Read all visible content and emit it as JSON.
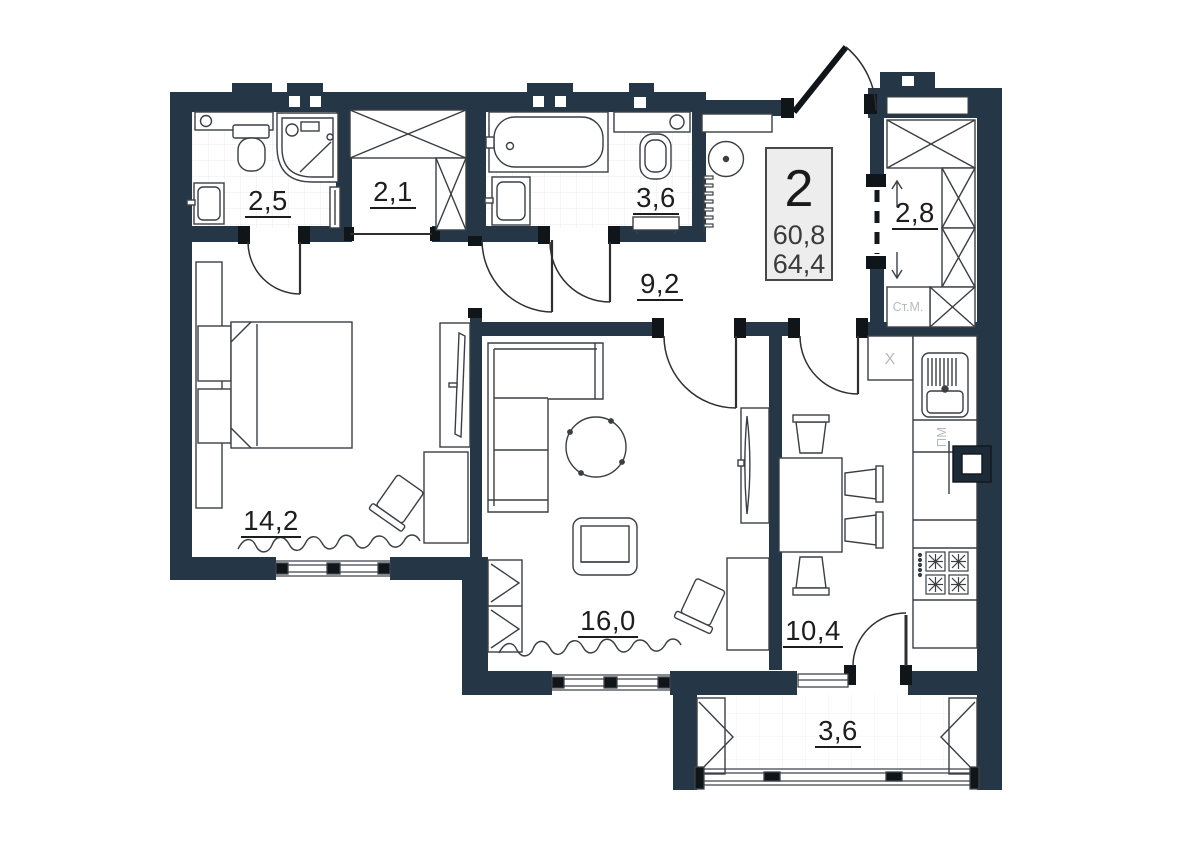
{
  "plan": {
    "info_box": {
      "rooms_count": "2",
      "area_main": "60,8",
      "area_total": "64,4"
    },
    "rooms": {
      "ensuite_bathroom": {
        "area": "2,5"
      },
      "wardrobe": {
        "area": "2,1"
      },
      "bathroom": {
        "area": "3,6"
      },
      "hallway": {
        "area": "9,2"
      },
      "laundry": {
        "area": "2,8"
      },
      "bedroom": {
        "area": "14,2"
      },
      "living_room": {
        "area": "16,0"
      },
      "kitchen": {
        "area": "10,4"
      },
      "balcony": {
        "area": "3,6"
      }
    },
    "annotations": {
      "washing_machine": "Ст.М.",
      "dishwasher": "ПМ",
      "corner_sink_marker": "X"
    },
    "colors": {
      "wall": "#253747",
      "jamb": "#10151a",
      "floor": "#ffffff",
      "tile_line": "#e7ebee",
      "furniture_line": "#3a3f44",
      "muted_text": "#b6babe",
      "label_text": "#1d1d1d",
      "info_box_bg": "#ededed",
      "info_box_border": "#474747"
    }
  }
}
